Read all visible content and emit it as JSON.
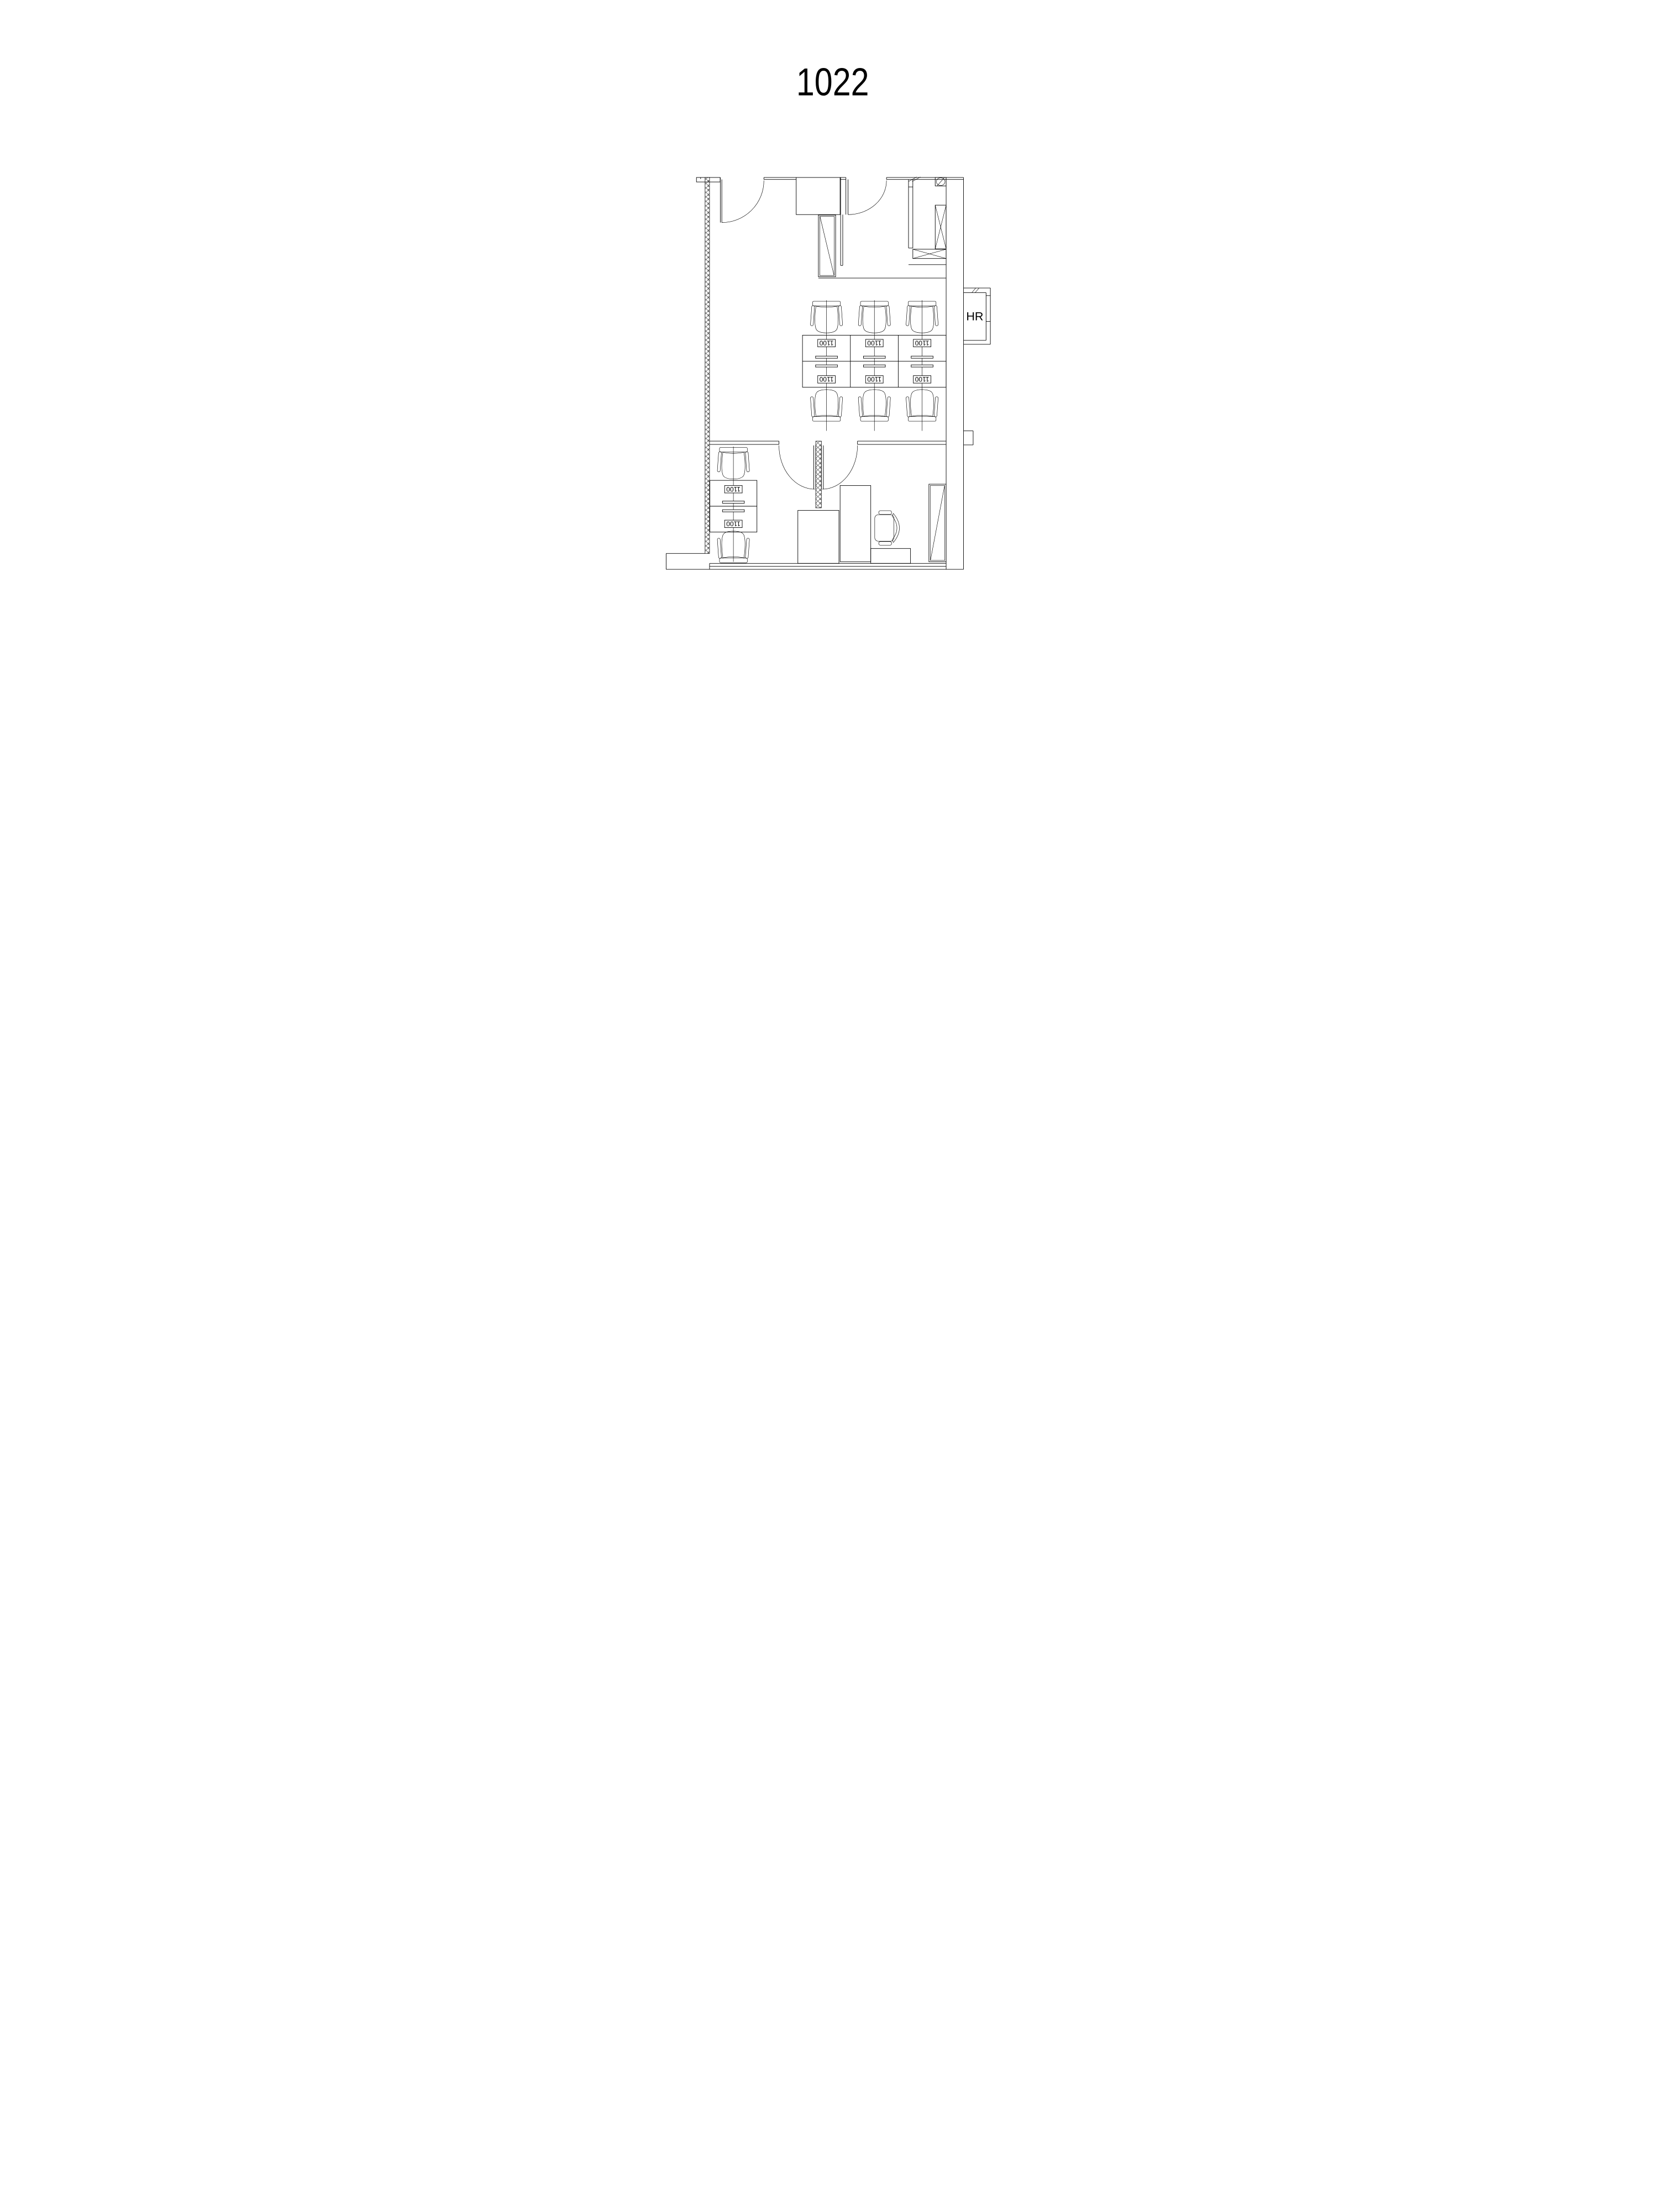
{
  "title": "1022",
  "plan": {
    "hr_label": "HR",
    "desk_label": "1100",
    "desk_count_main_cluster": 6,
    "desk_count_left_cluster": 2
  },
  "style": {
    "line_color": "#000000",
    "background": "#ffffff"
  }
}
